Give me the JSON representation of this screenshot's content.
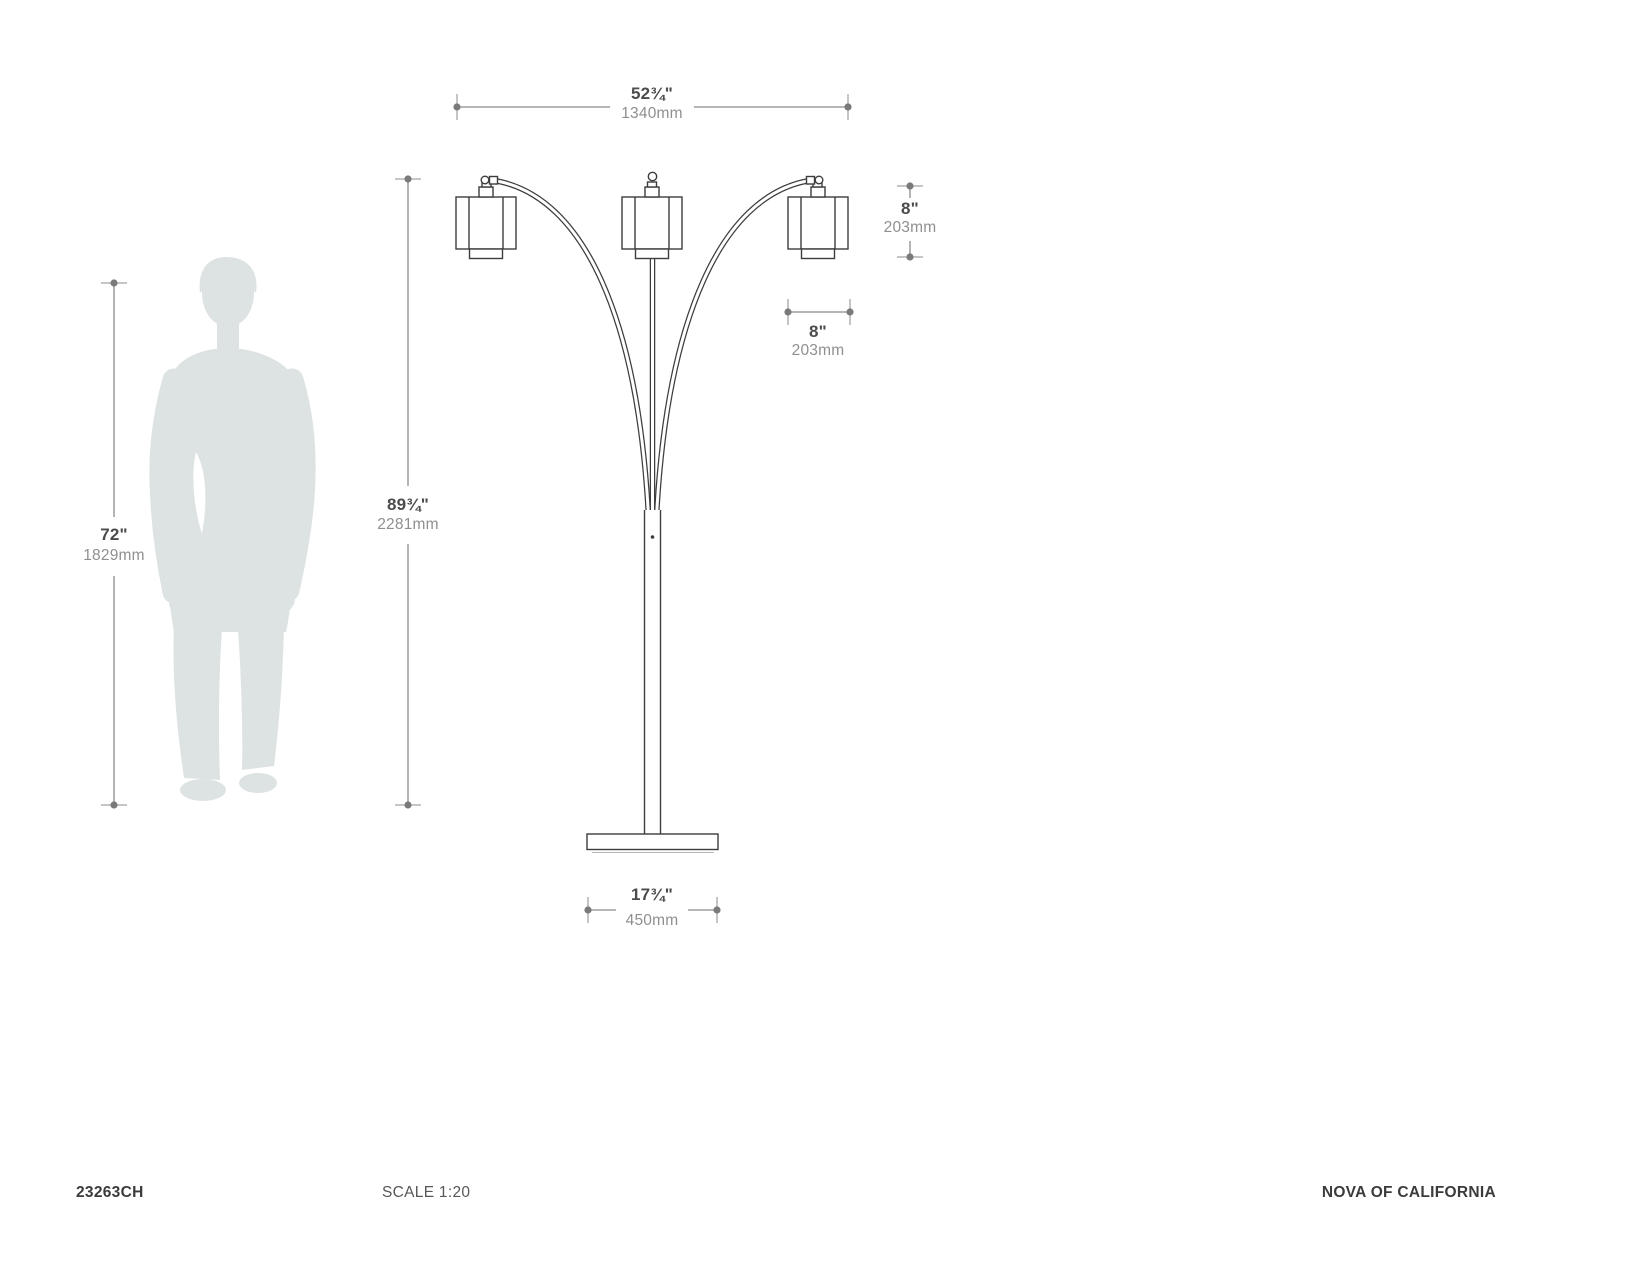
{
  "document_type": "product dimension spec sheet",
  "footer": {
    "model_number": "23263CH",
    "scale": "SCALE 1:20",
    "brand": "NOVA OF CALIFORNIA"
  },
  "dimensions": {
    "overall_width": {
      "inches": "52¾\"",
      "metric": "1340mm"
    },
    "fixture_height": {
      "inches": "89¾\"",
      "metric": "2281mm"
    },
    "person_height": {
      "inches": "72\"",
      "metric": "1829mm"
    },
    "shade_height": {
      "inches": "8\"",
      "metric": "203mm"
    },
    "shade_width": {
      "inches": "8\"",
      "metric": "203mm"
    },
    "base_width": {
      "inches": "17¾\"",
      "metric": "450mm"
    }
  },
  "colors": {
    "line_art": "#3d3d3d",
    "dimension_lines": "#8b8b8b",
    "dimension_text_primary": "#4c4c4c",
    "dimension_text_secondary": "#8f8f8f",
    "silhouette": "#dde3e3",
    "footer_text": "#3b3b3b",
    "background": "#ffffff"
  }
}
